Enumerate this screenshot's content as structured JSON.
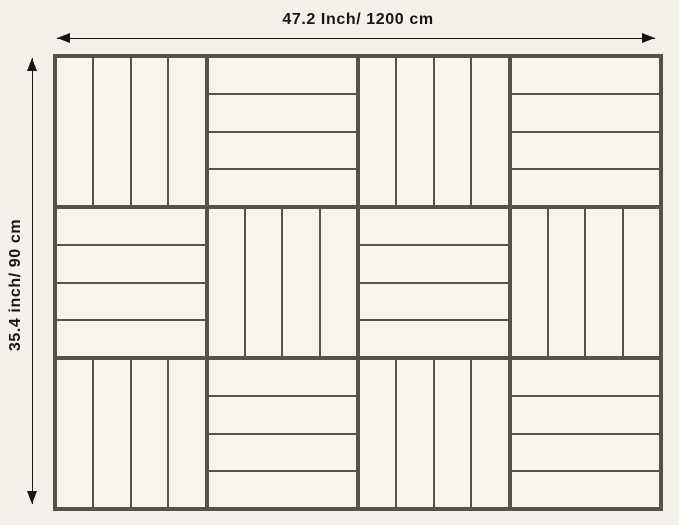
{
  "diagram": {
    "width_label": "47.2 Inch/ 1200 cm",
    "height_label": "35.4 inch/ 90 cm",
    "colors": {
      "background": "#f4f1ea",
      "tile_fill": "#f7f4ee",
      "grid_line": "#55524c",
      "arrow_and_text": "#161616"
    },
    "grid": {
      "rows": 3,
      "cols": 4,
      "slats_per_tile": 4,
      "pattern": [
        [
          "vertical",
          "horizontal",
          "vertical",
          "horizontal"
        ],
        [
          "horizontal",
          "vertical",
          "horizontal",
          "vertical"
        ],
        [
          "vertical",
          "horizontal",
          "vertical",
          "horizontal"
        ]
      ]
    }
  }
}
